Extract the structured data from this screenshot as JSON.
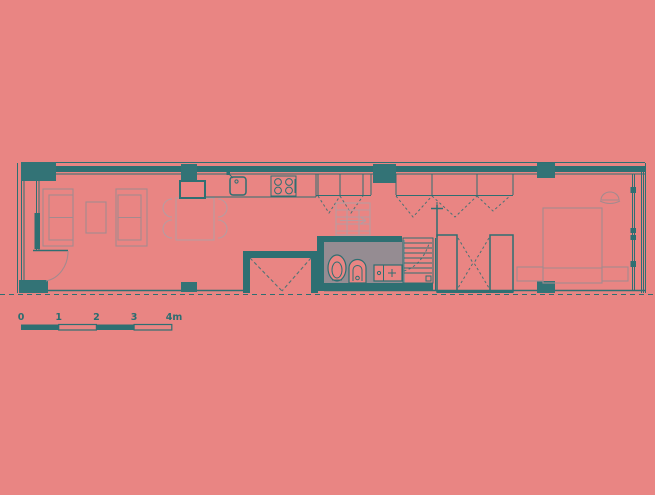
{
  "drawing": {
    "kind": "apartment floor plan",
    "scale_bar": {
      "tick_labels": [
        "0",
        "1",
        "2",
        "3",
        "4m"
      ],
      "unit": "m"
    }
  },
  "colors": {
    "background": "#e98583",
    "wall": "#2e6f72",
    "pillar": "#337376",
    "furniture": "#a48a8e",
    "furniture_light": "#b79ca0",
    "core": "#958c92",
    "text": "#2b6d70"
  }
}
